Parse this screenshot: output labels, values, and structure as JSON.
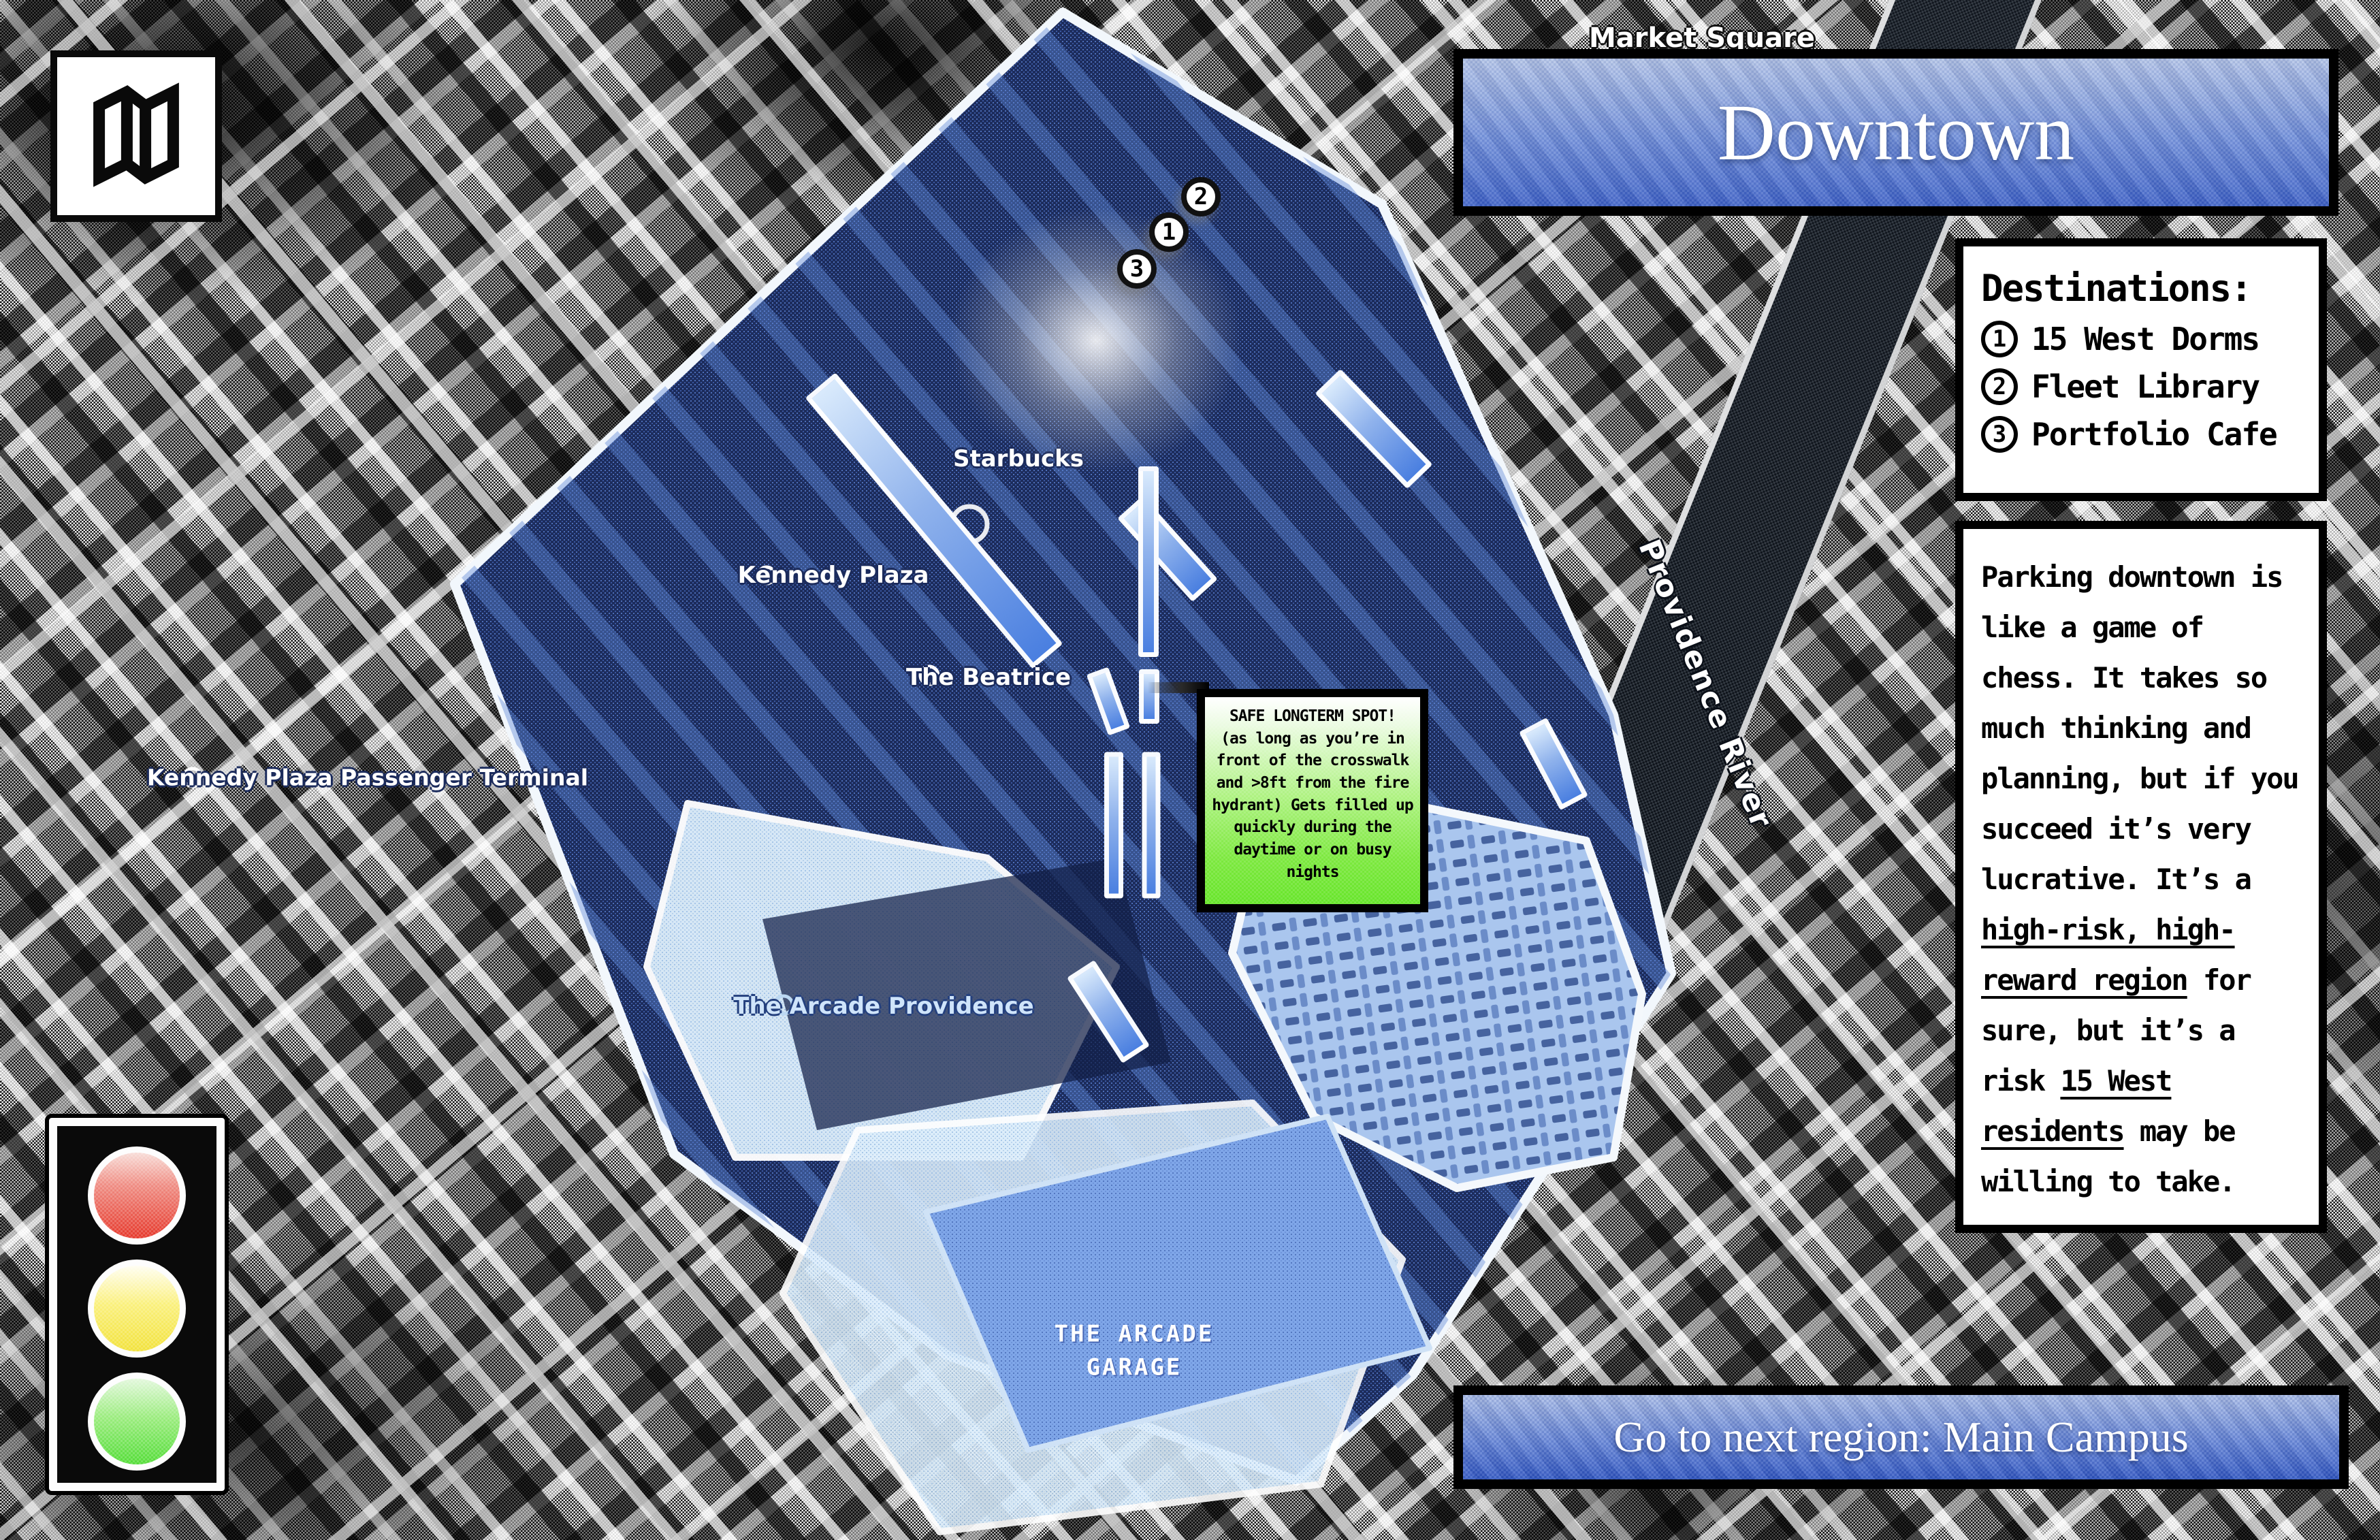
{
  "region": {
    "title": "Downtown"
  },
  "map_icon_button": {
    "icon": "folded-map-icon"
  },
  "destinations_panel": {
    "heading": "Destinations:",
    "items": [
      {
        "number": "1",
        "label": "15 West Dorms"
      },
      {
        "number": "2",
        "label": "Fleet Library"
      },
      {
        "number": "3",
        "label": "Portfolio Cafe"
      }
    ]
  },
  "info_panel": {
    "segments": [
      {
        "text": "Parking downtown is like a game of chess. It takes so much thinking and planning, but if you succeed it’s very lucrative. It’s a ",
        "underline": false
      },
      {
        "text": "high-risk, high-reward region",
        "underline": true
      },
      {
        "text": " for sure, but it’s a risk ",
        "underline": false
      },
      {
        "text": "15 West residents",
        "underline": true
      },
      {
        "text": " may be willing to take.",
        "underline": false
      }
    ]
  },
  "callout": {
    "title": "SAFE LONGTERM SPOT!",
    "body": "(as long as you’re in front of the crosswalk and >8ft from the fire hydrant) Gets filled up quickly during the daytime or on busy nights"
  },
  "next_region_button": {
    "label": "Go to next region: Main Campus"
  },
  "traffic_light": {
    "lights": [
      {
        "name": "red",
        "color": "#e6392c"
      },
      {
        "name": "yellow",
        "color": "#f2e23c"
      },
      {
        "name": "green",
        "color": "#54dd38"
      }
    ]
  },
  "map": {
    "markers": [
      {
        "number": "2"
      },
      {
        "number": "1"
      },
      {
        "number": "3"
      }
    ],
    "labels": {
      "market_square": "Market Square",
      "starbucks": "Starbucks",
      "kennedy_plaza": "Kennedy Plaza",
      "the_beatrice": "The Beatrice",
      "kennedy_plaza_passenger_terminal": "Kennedy Plaza Passenger Terminal",
      "the_arcade_providence": "The Arcade Providence",
      "the_arcade_garage": "THE ARCADE GARAGE",
      "providence_river": "Providence River"
    }
  },
  "colors": {
    "banner_gradient_top": "#b2c3e6",
    "banner_gradient_bottom": "#3c60c6",
    "callout_green": "#6ee431",
    "highlight_navy": "#1c2c5c",
    "highlight_strip_blue": "#4a7fe0",
    "pale_zone_blue": "#ddeefb",
    "garage_blue": "#7fa6e8"
  }
}
